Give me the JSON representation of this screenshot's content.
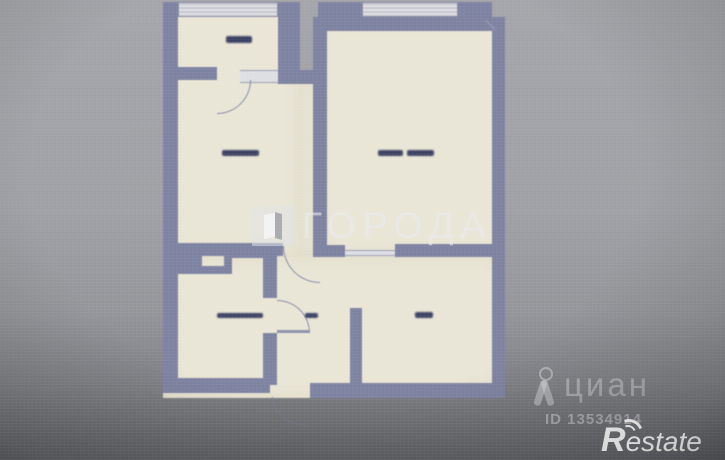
{
  "watermarks": {
    "goroda": {
      "text": "ГОРОДА",
      "icon": "open-door-square-logo"
    },
    "cian": {
      "text": "циан",
      "listing_id": "ID 13534914",
      "icon": "person-ribbon-pin-logo"
    },
    "restate": {
      "initial": "R",
      "rest": "estate",
      "icon": "double-wave-arcs"
    }
  },
  "floorplan": {
    "room_labels_illegible": true,
    "label_count": 6,
    "features": [
      "balcony with window band",
      "kitchen",
      "living room with window",
      "stepped bathroom",
      "hallway",
      "entry room",
      "five door swing arcs"
    ]
  },
  "colors": {
    "background_top": "#a4a5aa",
    "background_bottom": "#606165",
    "paper": "#eae6d6",
    "wall": "#7e83a1",
    "window_band": "#c6c7ce",
    "label_ink": "#3c4163",
    "watermark_light": "rgba(230,231,235,0.55)",
    "restate_white": "#f8f8f8"
  }
}
